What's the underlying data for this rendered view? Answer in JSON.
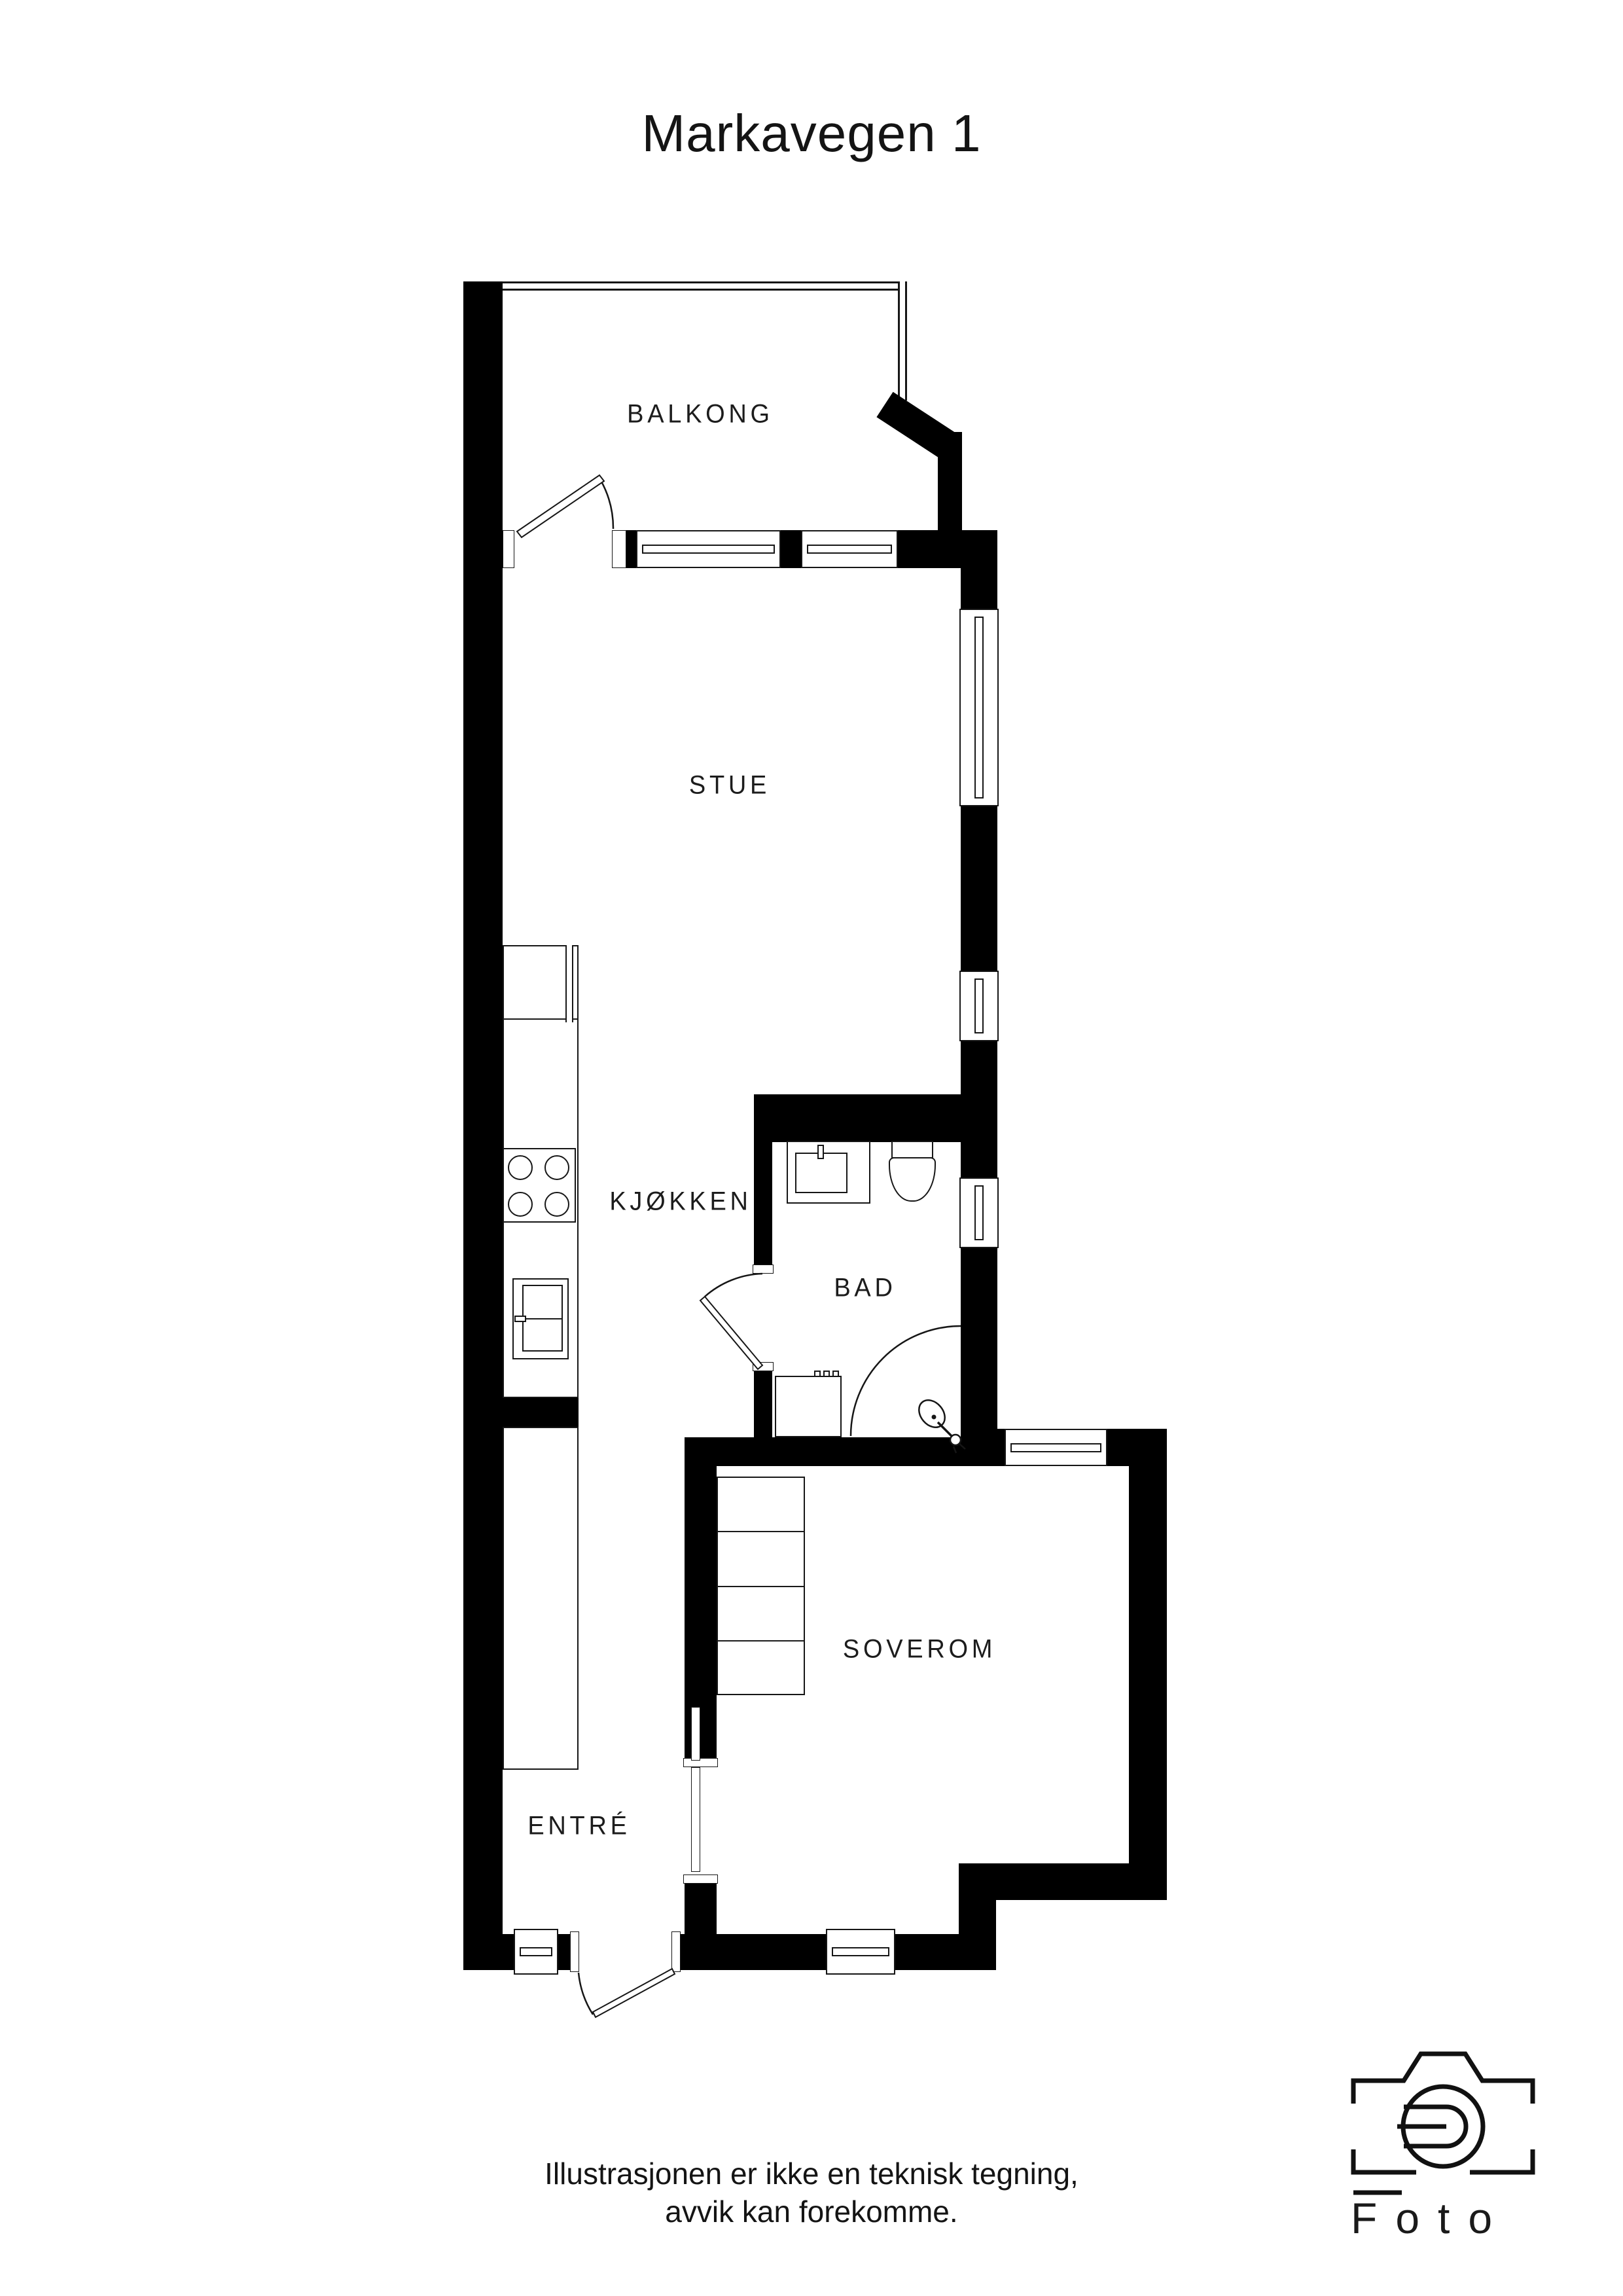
{
  "title": "Markavegen 1",
  "rooms": {
    "balcony": {
      "label": "BALKONG"
    },
    "living_room": {
      "label": "STUE"
    },
    "kitchen": {
      "label": "KJØKKEN"
    },
    "bathroom": {
      "label": "BAD"
    },
    "bedroom": {
      "label": "SOVEROM"
    },
    "entry": {
      "label": "ENTRÉ"
    }
  },
  "disclaimer": {
    "line1": "Illustrasjonen er ikke en teknisk tegning,",
    "line2": "avvik kan forekomme."
  },
  "logo": {
    "wordmark": "Foto",
    "icon": "camera-line-icon"
  },
  "colors": {
    "wall": "#000000",
    "line": "#161616",
    "text": "#141414",
    "background": "#ffffff"
  }
}
